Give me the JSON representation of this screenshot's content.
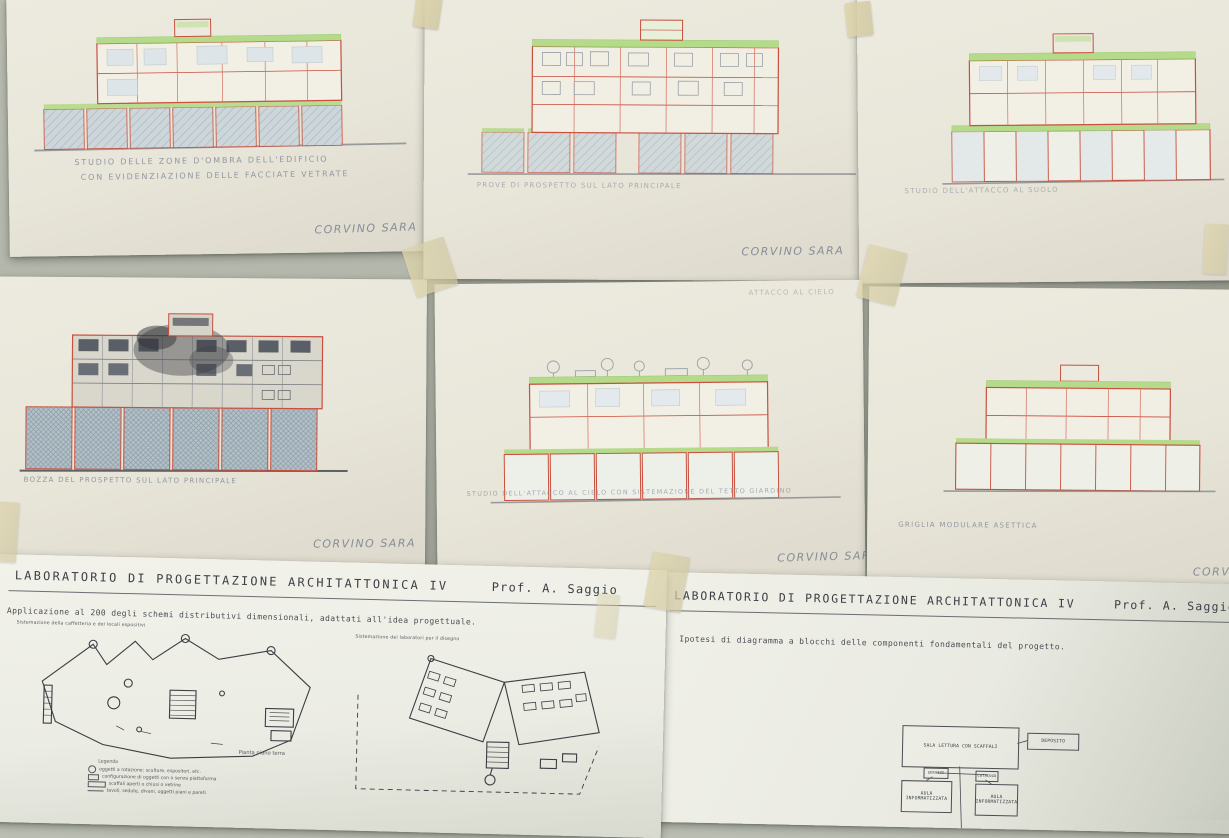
{
  "sheets": {
    "top_left": {
      "caption_line1": "STUDIO DELLE ZONE D'OMBRA DELL'EDIFICIO",
      "caption_line2": "CON EVIDENZIAZIONE DELLE FACCIATE VETRATE",
      "signature": "CORVINO SARA"
    },
    "top_center": {
      "caption": "PROVE DI PROSPETTO SUL LATO PRINCIPALE",
      "signature": "CORVINO SARA"
    },
    "top_right": {
      "caption": "STUDIO DELL'ATTACCO AL SUOLO"
    },
    "middle_left": {
      "caption": "BOZZA DEL PROSPETTO SUL LATO PRINCIPALE",
      "signature": "CORVINO SARA"
    },
    "middle_center": {
      "header": "ATTACCO AL CIELO",
      "caption": "STUDIO DELL'ATTACCO AL CIELO CON SISTEMAZIONE DEL TETTO GIARDINO",
      "signature": "CORVINO SARA"
    },
    "middle_right": {
      "caption": "GRIGLIA MODULARE ASETTICA",
      "signature_partial": "CORVI"
    },
    "bottom_left": {
      "title": "LABORATORIO DI PROGETTAZIONE ARCHITATTONICA IV",
      "professor": "Prof. A. Saggio",
      "subtitle": "Applicazione al 200 degli schemi distributivi dimensionali, adattati all'idea progettuale.",
      "plan_left_note": "Sistemazione della caffetteria e dei locali espositivi",
      "plan_right_note": "Sistemazione dei laboratori per il disegno",
      "plan_caption": "Pianta piano terra",
      "legend_title": "Legenda",
      "legend_items": [
        "oggetti a rotazione: sculture, espositori, etc.",
        "configurazione di oggetti con o senza piattaforma",
        "scaffali aperti o chiusi o vetrine",
        "tavoli, sedute, divani, oggetti piani e pareti"
      ]
    },
    "bottom_right": {
      "title": "LABORATORIO DI PROGETTAZIONE ARCHITATTONICA IV",
      "professor": "Prof. A. Saggio",
      "subtitle": "Ipotesi di diagramma a blocchi delle componenti fondamentali del progetto.",
      "diagram": {
        "main": "SALA LETTURA CON SCAFFALI",
        "deposito": "DEPOSITO",
        "servizi": "SERVIZI",
        "catalogo": "CATALOGO",
        "aula_left": "AULA INFORMATIZZATA",
        "aula_right": "AULA INFORMATIZZATA"
      }
    }
  },
  "colors": {
    "red_pen": "#c94f3e",
    "green_marker": "#b4da8a",
    "glass_blue": "#c6d1d6",
    "pencil_gray": "#9298a2",
    "wall": "#aeb2a6"
  }
}
